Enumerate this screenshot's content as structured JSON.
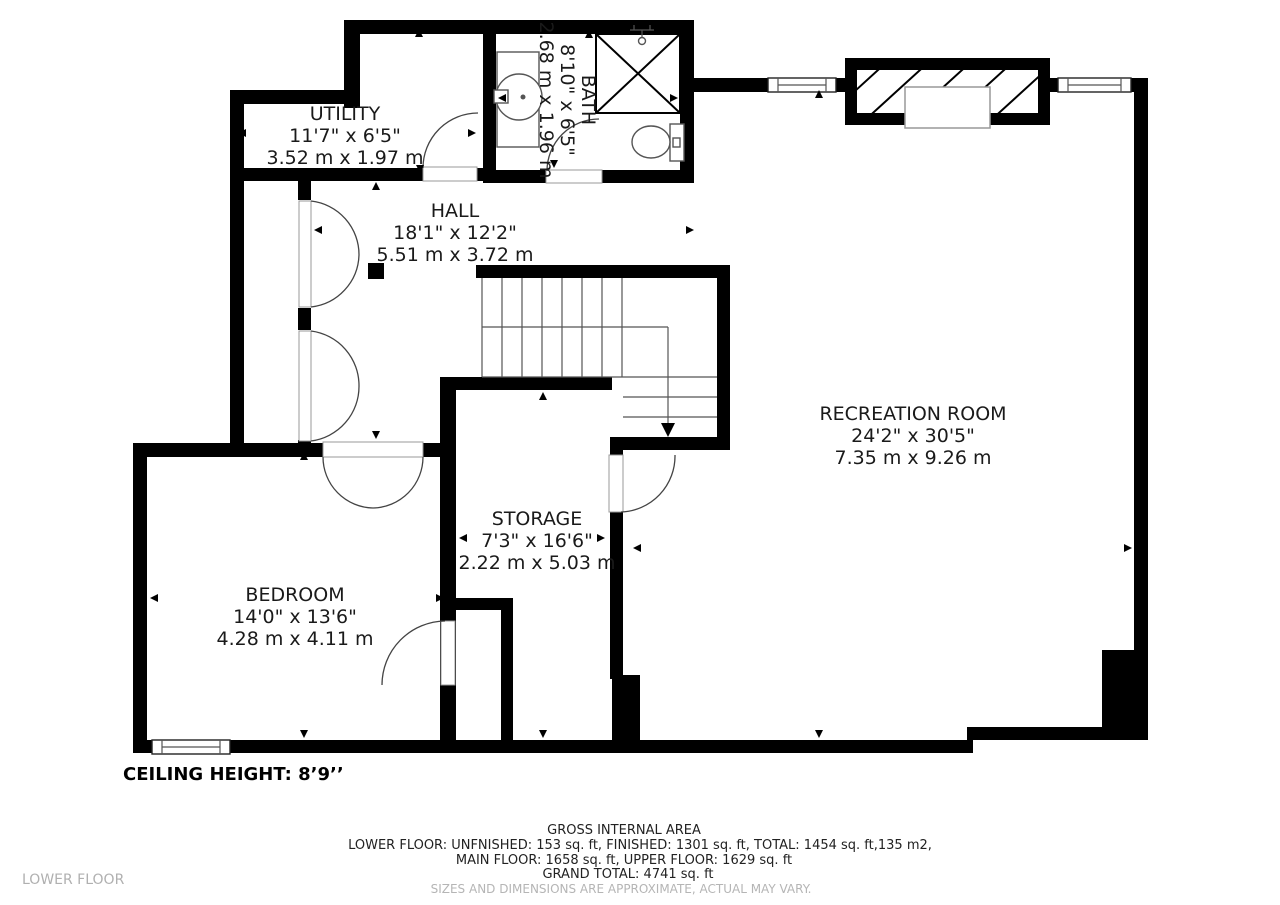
{
  "floor": {
    "label": "LOWER FLOOR",
    "ceiling_note": "CEILING HEIGHT: 8’9’’"
  },
  "rooms": [
    {
      "id": "utility",
      "name": "UTILITY",
      "imperial": "11'7\" x 6'5\"",
      "metric": "3.52 m x 1.97 m"
    },
    {
      "id": "bath",
      "name": "BATH",
      "imperial": "8'10\" x 6'5\"",
      "metric": "2.68 m x 1.96 m"
    },
    {
      "id": "hall",
      "name": "HALL",
      "imperial": "18'1\" x 12'2\"",
      "metric": "5.51 m x 3.72 m"
    },
    {
      "id": "recreation",
      "name": "RECREATION ROOM",
      "imperial": "24'2\" x 30'5\"",
      "metric": "7.35 m x 9.26 m"
    },
    {
      "id": "storage",
      "name": "STORAGE",
      "imperial": "7'3\" x 16'6\"",
      "metric": "2.22 m x 5.03 m"
    },
    {
      "id": "bedroom",
      "name": "BEDROOM",
      "imperial": "14'0\" x 13'6\"",
      "metric": "4.28 m x 4.11 m"
    }
  ],
  "footer": {
    "title": "GROSS INTERNAL AREA",
    "line1": "LOWER FLOOR: UNFNISHED: 153 sq. ft, FINISHED: 1301 sq. ft, TOTAL: 1454 sq. ft,135 m2,",
    "line2": "MAIN FLOOR: 1658 sq. ft, UPPER FLOOR: 1629 sq. ft",
    "line3": "GRAND TOTAL: 4741 sq. ft",
    "disclaimer": "SIZES AND DIMENSIONS ARE APPROXIMATE, ACTUAL MAY VARY."
  },
  "icons": {
    "sink": "sink-icon",
    "toilet": "toilet-icon",
    "shower": "shower-icon",
    "stairs_direction": "down-arrow-icon"
  },
  "colors": {
    "wall": "#000000",
    "label_text": "#1a1a1a",
    "muted_text": "#b5b5b5",
    "frame_stroke": "#999999"
  }
}
